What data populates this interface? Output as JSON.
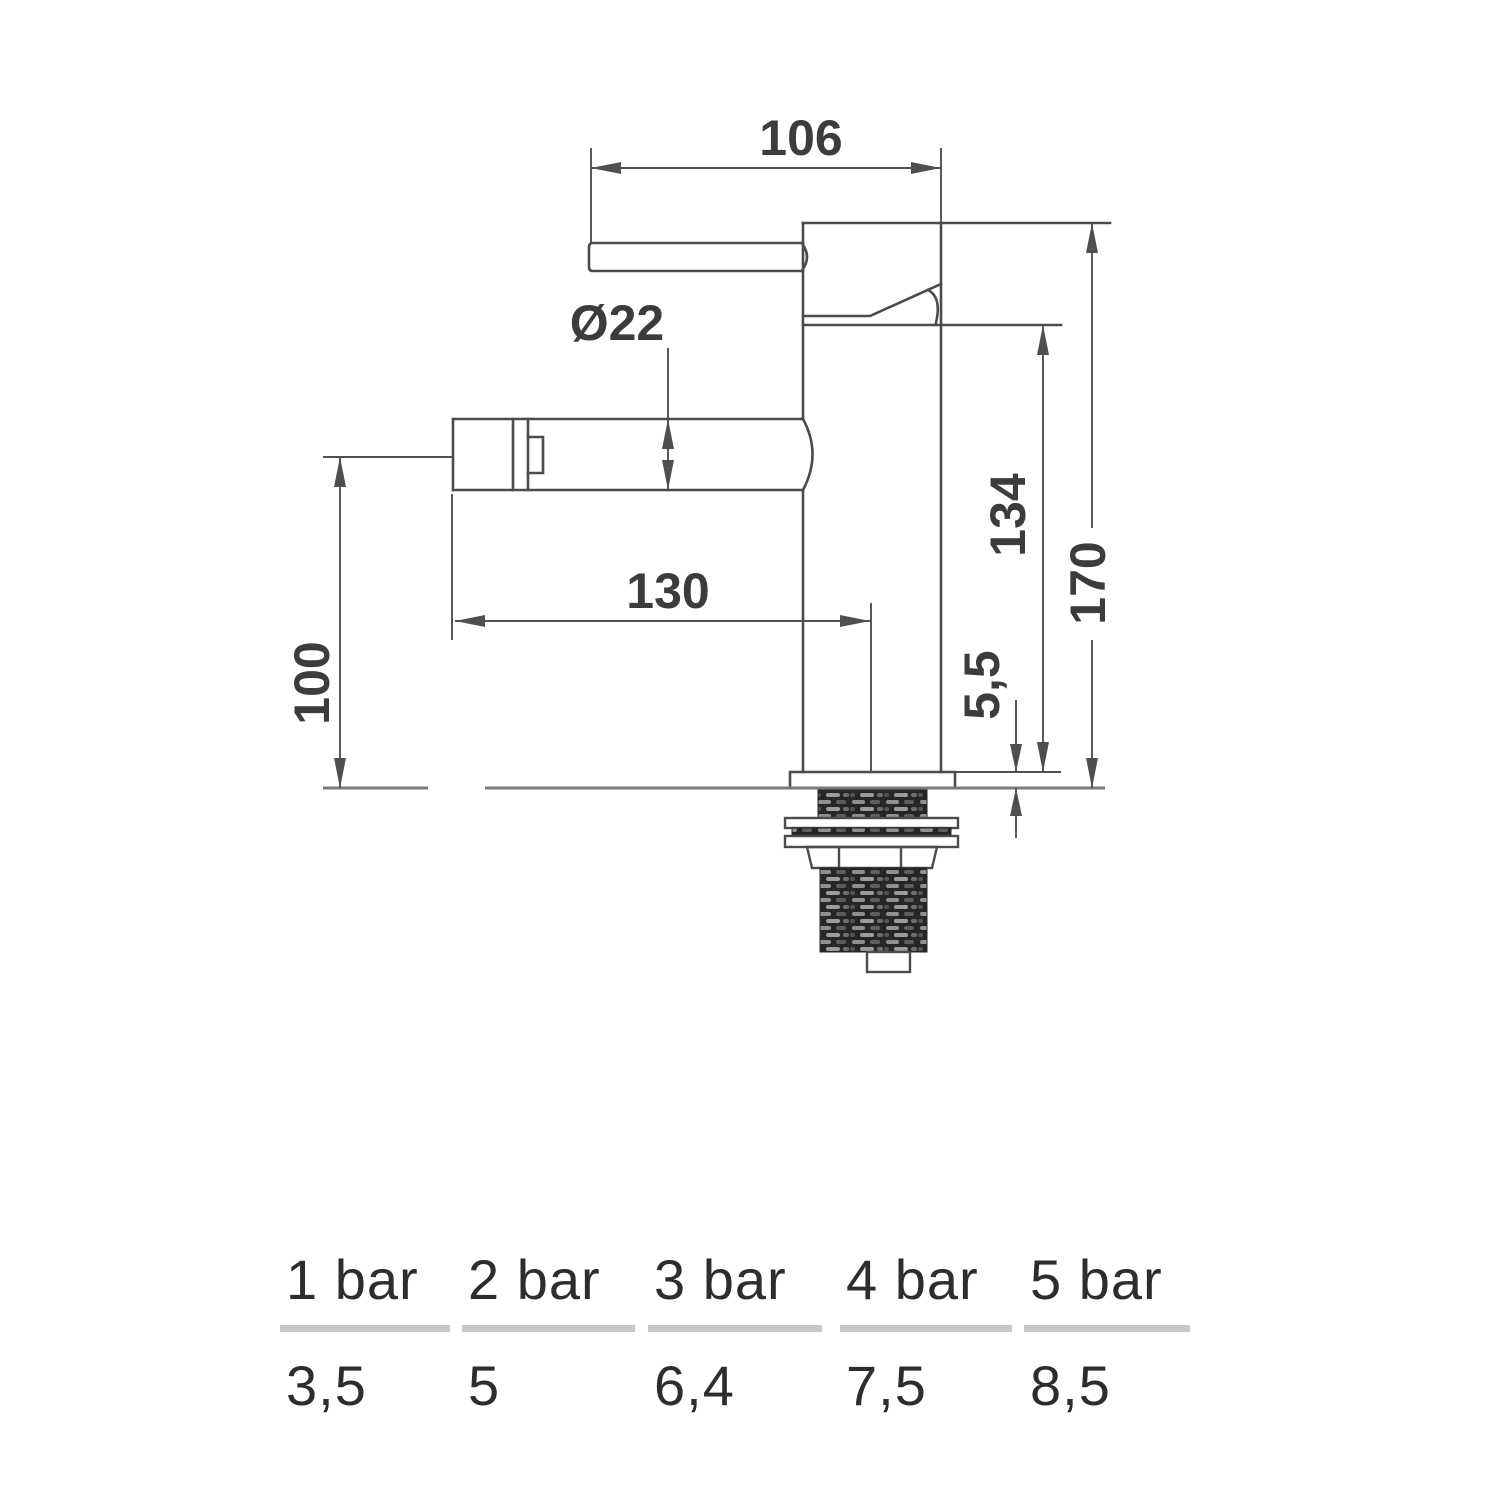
{
  "drawing": {
    "dim_top_width": "106",
    "dim_spout_diameter": "Ø22",
    "dim_spout_reach": "130",
    "dim_spout_height": "100",
    "dim_body_height": "134",
    "dim_total_height": "170",
    "dim_base_plate": "5,5"
  },
  "flow_table": {
    "columns": [
      {
        "pressure": "1 bar",
        "flow": "3,5"
      },
      {
        "pressure": "2 bar",
        "flow": "5"
      },
      {
        "pressure": "3 bar",
        "flow": "6,4"
      },
      {
        "pressure": "4 bar",
        "flow": "7,5"
      },
      {
        "pressure": "5 bar",
        "flow": "8,5"
      }
    ]
  },
  "colors": {
    "outline": "#4b4b4b",
    "dimension_line": "#4f4f4f",
    "dimension_text": "#3c3c3c",
    "table_text": "#2d2d2d",
    "table_divider": "#c7c7c7",
    "thread_dark": "#262626"
  }
}
